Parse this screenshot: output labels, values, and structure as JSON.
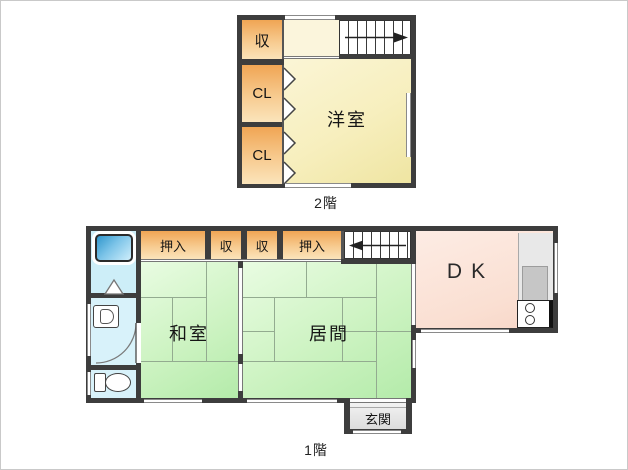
{
  "title": "house floor plan",
  "palette": {
    "wall": "#3d3d3d",
    "closet_orange": "#f3b266",
    "western_room_cream": "#f5edb6",
    "tatami_green": "#c6f0ba",
    "dining_kitchen_pink": "#fadfd2",
    "bath_blue": "#cdeef8",
    "genkan_gray": "#e4e4e4"
  },
  "floor2": {
    "label": "2階",
    "storage_label": "収",
    "closets": [
      "CL",
      "CL"
    ],
    "western_room_label": "洋室"
  },
  "floor1": {
    "label": "1階",
    "closets": [
      "押入",
      "収",
      "収",
      "押入"
    ],
    "washitsu_label": "和室",
    "ima_label": "居間",
    "dk_label": "DK",
    "genkan_label": "玄関"
  }
}
